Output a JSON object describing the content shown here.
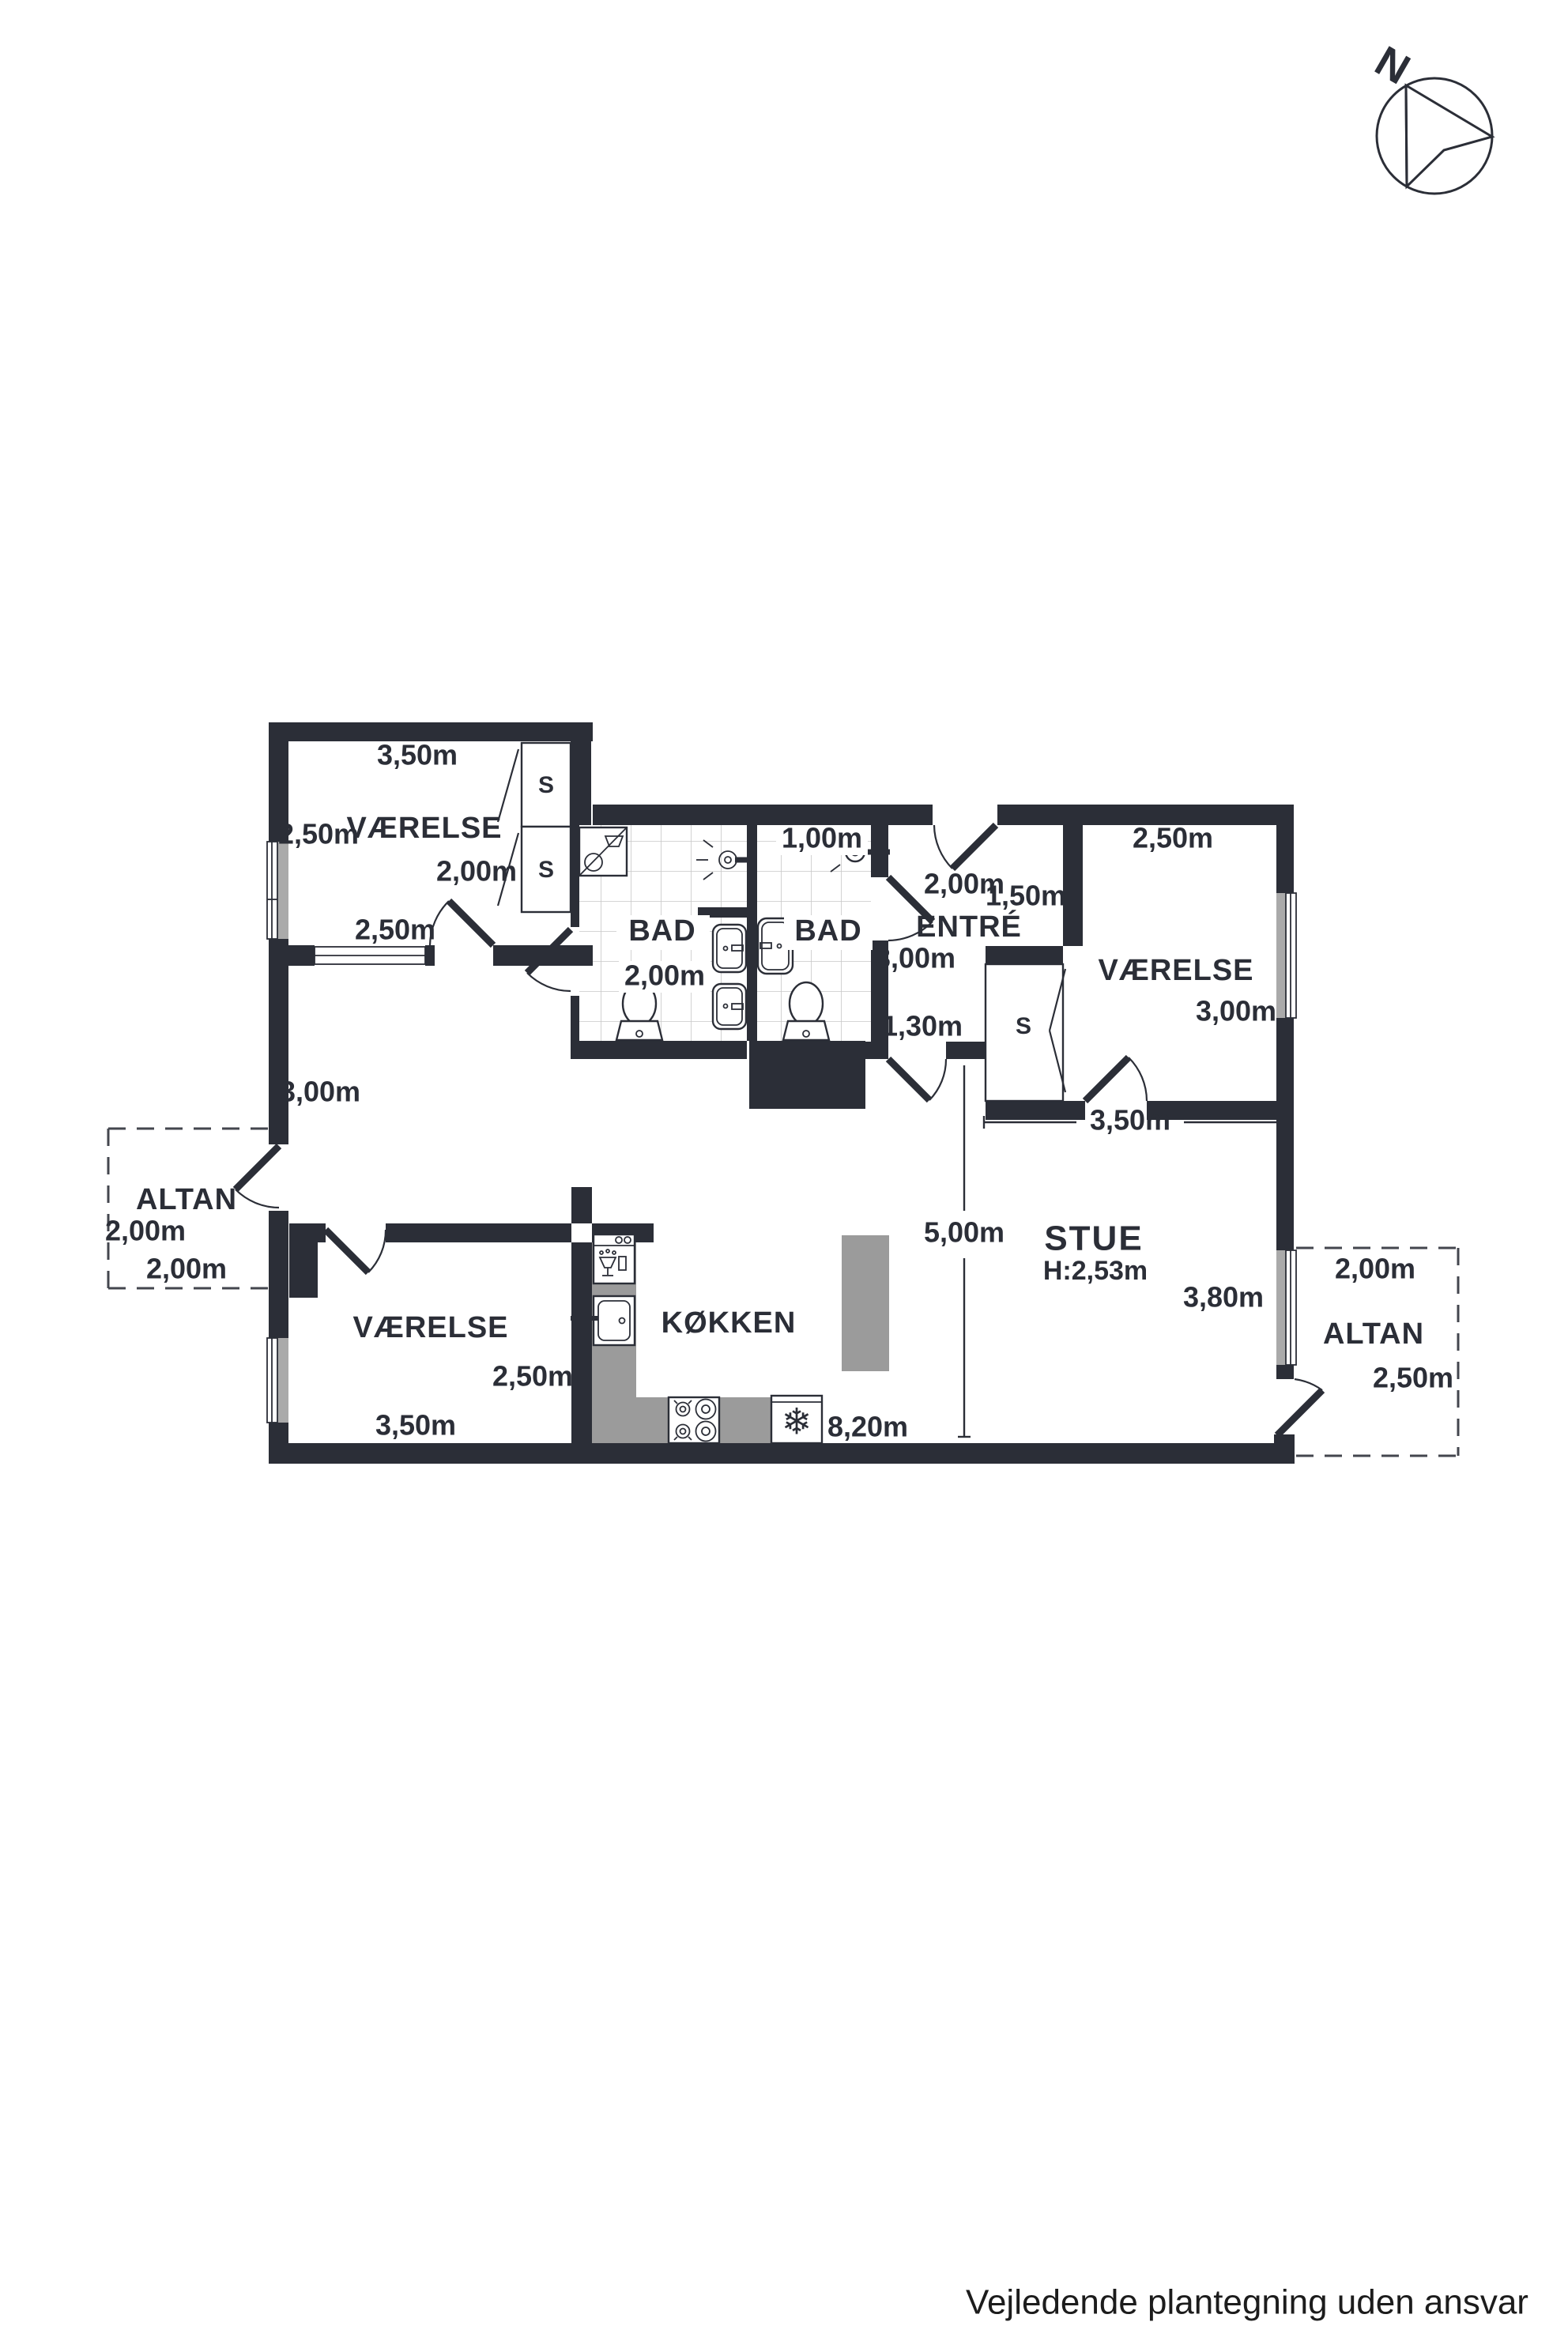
{
  "footer": {
    "disclaimer": "Vejledende plantegning uden ansvar"
  },
  "compass": {
    "north_label": "N"
  },
  "colors": {
    "wall": "#2b2e37",
    "counter": "#9b9b9b",
    "window_glass": "#aaaaaa",
    "tile_line": "#c7c7c7",
    "dashed_outline": "#43464e",
    "text": "#2b2e37"
  },
  "icons": {
    "freezer_glyph": "❄"
  },
  "plan": {
    "rooms": {
      "vaerelse_nw": {
        "label": "VÆRELSE",
        "dim_width": "3,50m",
        "dim_depth": "2,50m",
        "dim_closet": "2,00m",
        "dim_window": "2,50m",
        "closet_a": "S",
        "closet_b": "S"
      },
      "bad_west": {
        "label": "BAD",
        "dim_width": "2,00m"
      },
      "bad_east": {
        "label": "BAD",
        "dim_width": "1,00m"
      },
      "entre": {
        "label": "ENTRÉ",
        "dim_entrance": "2,00m",
        "dim_width": "1,50m",
        "dim_depth": "3,00m",
        "dim_passage": "1,30m",
        "closet": "S"
      },
      "vaerelse_ne": {
        "label": "VÆRELSE",
        "dim_width": "2,50m",
        "dim_depth": "3,00m",
        "dim_total_width": "3,50m"
      },
      "hall": {
        "dim_wall": "3,00m"
      },
      "stue": {
        "label": "STUE",
        "ceiling_height": "H:2,53m",
        "dim_length": "5,00m",
        "dim_window": "3,80m"
      },
      "koekken": {
        "label": "KØKKEN",
        "dim_length": "8,20m"
      },
      "vaerelse_sw": {
        "label": "VÆRELSE",
        "dim_depth": "2,50m",
        "dim_width": "3,50m"
      },
      "altan_west": {
        "label": "ALTAN",
        "dim_depth": "2,00m",
        "dim_width": "2,00m"
      },
      "altan_east": {
        "label": "ALTAN",
        "dim_width": "2,00m",
        "dim_depth": "2,50m"
      }
    }
  }
}
